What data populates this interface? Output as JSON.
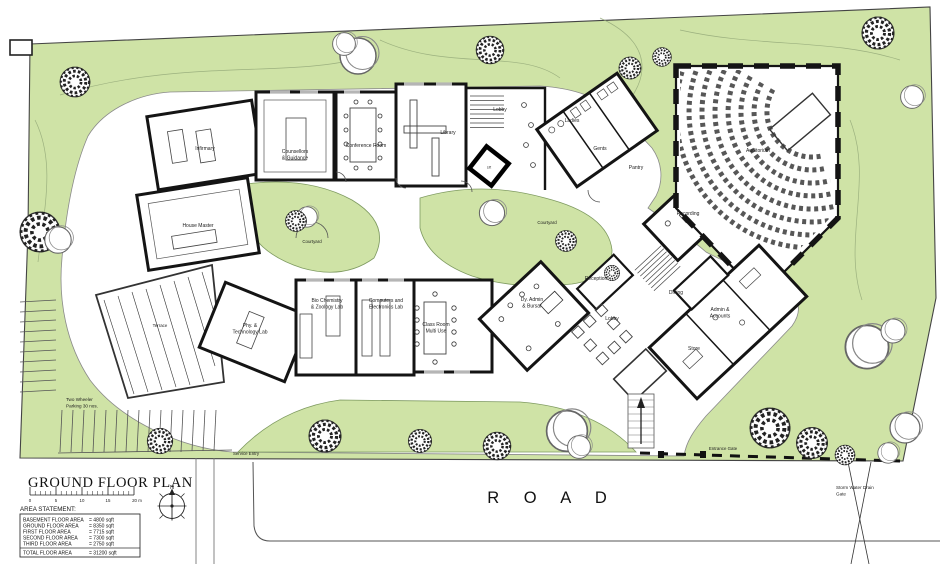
{
  "colors": {
    "site_green": "#cfe3a6",
    "wall": "#141414",
    "window_gray": "#b5b5b5",
    "thin_line": "#555555"
  },
  "plan": {
    "road_label": "R O A D",
    "labels": {
      "courtyard_west": "Courtyard",
      "courtyard_center": "Courtyard",
      "terrace": "Terrace",
      "service_entry": "Service Entry",
      "entrance_gate": "Entrance Gate",
      "two_wheeler_l1": "Two Wheeler",
      "two_wheeler_l2": "Parking 30 nos.",
      "drain_l1": "Storm Water Drain",
      "drain_l2": "Gate"
    },
    "rooms": {
      "infirmary": "Infirmary",
      "house_master": "House Master",
      "counsellors_l1": "Counsellors",
      "counsellors_l2": "& Guidance",
      "conference": "Conference Room",
      "library": "Library",
      "lobby_upper": "Lobby",
      "lift": "Lift",
      "ladies": "Ladies",
      "gents": "Gents",
      "pantry": "Pantry",
      "recording": "Recording",
      "auditorium": "Auditorium",
      "dining": "Dining",
      "admin_l1": "Admin &",
      "admin_l2": "Accounts",
      "store": "Store",
      "reception": "Reception",
      "lobby_lower": "Lobby",
      "phy_l1": "Phy. &",
      "phy_l2": "Technology Lab",
      "biochem_l1": "Bio Chemistry",
      "biochem_l2": "& Zoology Lab",
      "computers_l1": "Computers and",
      "computers_l2": "Electronics Lab",
      "multiuse_l1": "Class Room",
      "multiuse_l2": "Multi Use",
      "dyadmin_l1": "Dy. Admin",
      "dyadmin_l2": "& Bursar"
    }
  },
  "title_block": {
    "title": "GROUND FLOOR PLAN",
    "area_heading": "AREA STATEMENT:",
    "area_rows": [
      {
        "label": "BASEMENT FLOOR AREA",
        "value": "= 4800 sqft"
      },
      {
        "label": "GROUND FLOOR AREA",
        "value": "= 8350 sqft"
      },
      {
        "label": "FIRST FLOOR AREA",
        "value": "= 7715 sqft"
      },
      {
        "label": "SECOND FLOOR AREA",
        "value": "= 7300 sqft"
      },
      {
        "label": "THIRD FLOOR AREA",
        "value": "= 2750 sqft"
      },
      {
        "label": "TOTAL FLOOR AREA",
        "value": "= 31200 sqft"
      }
    ],
    "scale_ticks": [
      "0",
      "5",
      "10",
      "15",
      "20 m"
    ],
    "north": "N"
  }
}
